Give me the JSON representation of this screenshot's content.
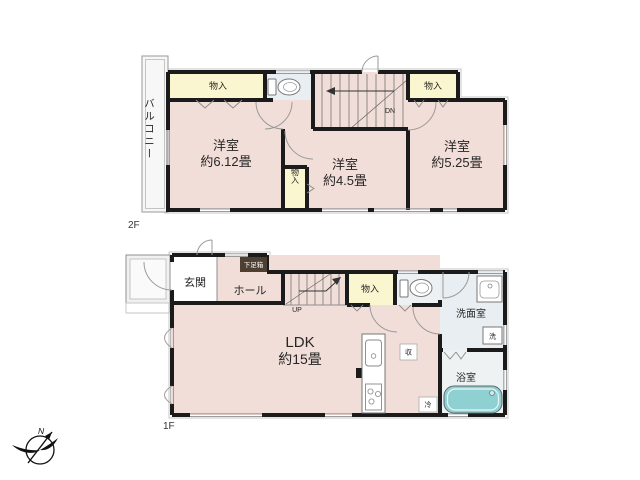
{
  "floor2": {
    "floor_label": "2F",
    "balcony_label": "バルコニー",
    "storage_left_label": "物入",
    "storage_right_label": "物入",
    "storage_small_label": "物入",
    "stairs_label": "DN",
    "rooms": [
      {
        "label": "洋室",
        "size": "約6.12畳"
      },
      {
        "label": "洋室",
        "size": "約4.5畳"
      },
      {
        "label": "洋室",
        "size": "約5.25畳"
      }
    ]
  },
  "floor1": {
    "floor_label": "1F",
    "entrance_label": "玄関",
    "hall_label": "ホール",
    "shoe_cabinet_label": "下足箱",
    "stairs_label": "UP",
    "storage_label": "物入",
    "ldk_label": "LDK",
    "ldk_size": "約15畳",
    "washroom_label": "洗面室",
    "washer_label": "洗",
    "bathroom_label": "浴室",
    "closet_label": "収",
    "fridge_label": "冷"
  },
  "compass": {
    "north_label": "N"
  },
  "colors": {
    "room_pink": "#f2ded9",
    "storage_yellow": "#faf7d0",
    "wet_area_blue": "#e8eef1",
    "bath_floor": "#eef2f3",
    "toilet_floor": "#eef1f3",
    "bathtub_teal": "#8fd0d3",
    "shoe_cabinet_brown": "#4e3f33",
    "porch_gray": "#f1f1f1"
  }
}
